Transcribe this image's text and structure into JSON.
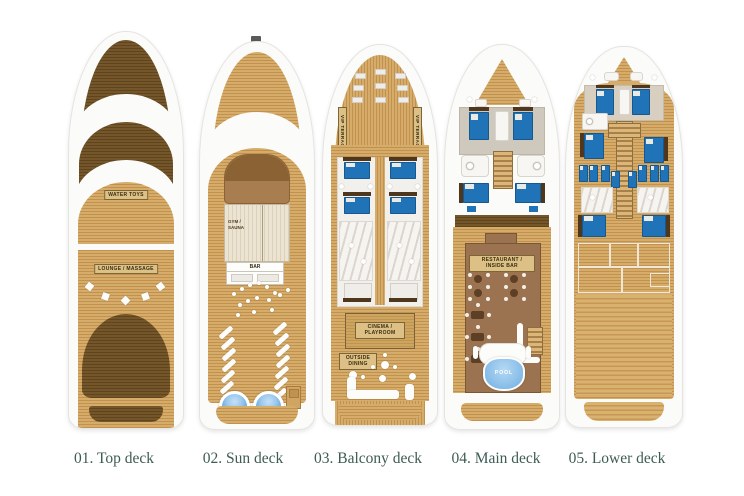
{
  "page_title": "Yacht deck plans",
  "decks": [
    {
      "id": "top-deck",
      "caption": "01. Top deck",
      "areas": {
        "water_toys": "WATER TOYS",
        "lounge_massage": "LOUNGE / MASSAGE"
      }
    },
    {
      "id": "sun-deck",
      "caption": "02. Sun deck",
      "areas": {
        "gym_sauna": "GYM / SAUNA",
        "bar": "BAR"
      }
    },
    {
      "id": "balcony-deck",
      "caption": "03. Balcony deck",
      "areas": {
        "vip_terrace_port": "VIP TERRACE",
        "vip_terrace_starboard": "VIP TERRACE",
        "cinema_playroom": "CINEMA / PLAYROOM",
        "outside_dining": "OUTSIDE DINING"
      }
    },
    {
      "id": "main-deck",
      "caption": "04. Main deck",
      "areas": {
        "restaurant_inside_bar": "RESTAURANT / INSIDE BAR",
        "pool": "POOL"
      }
    },
    {
      "id": "lower-deck",
      "caption": "05. Lower deck",
      "areas": {}
    }
  ],
  "colors": {
    "background": "#ffffff",
    "caption_text": "#3e5c54",
    "wood_light": "#d6ac6a",
    "wood_dark": "#6b5022",
    "structure_brown": "#9b7350",
    "bed_blue": "#2173b8",
    "pool_blue": "#8cc0ea",
    "jacuzzi_blue": "#4f9fdd",
    "label_tan": "#dcc086"
  }
}
